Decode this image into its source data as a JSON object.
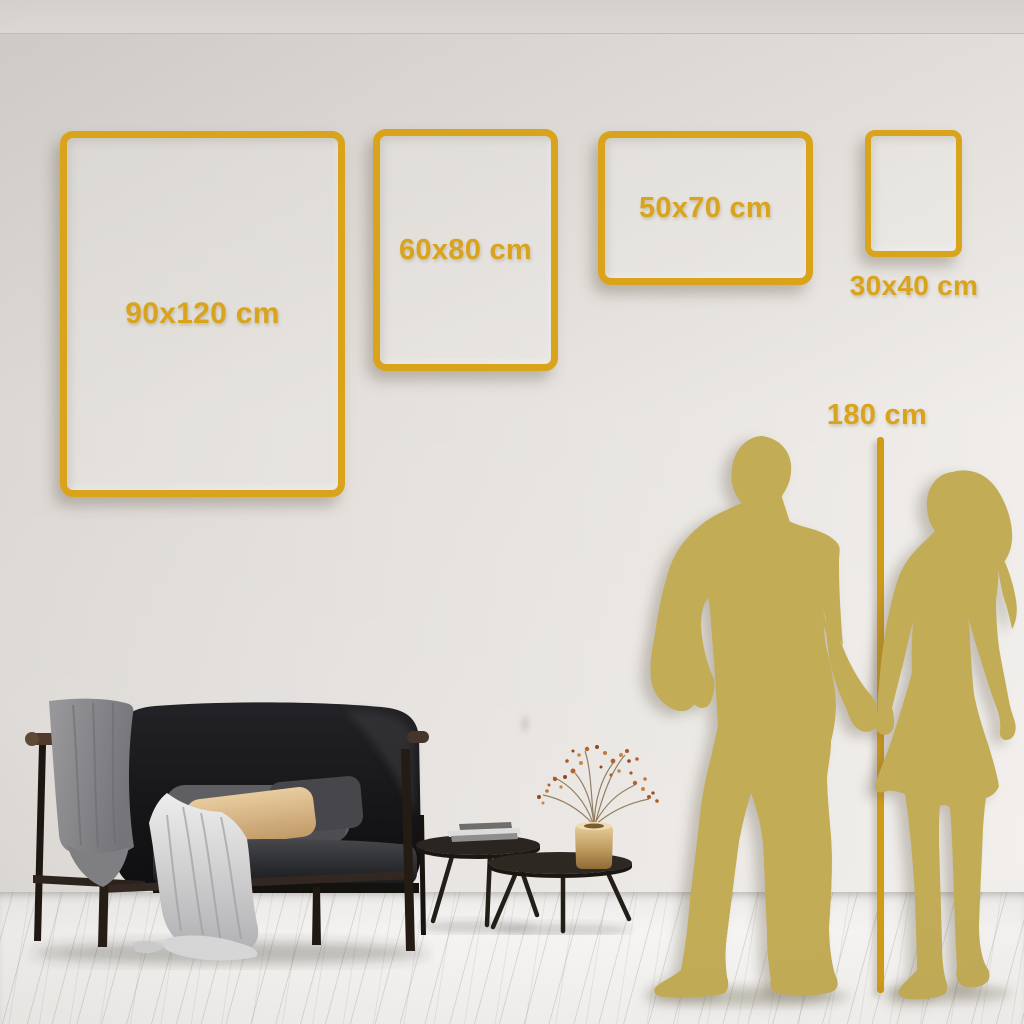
{
  "size_guide": {
    "frames": [
      {
        "label": "90x120 cm",
        "width_cm": 90,
        "height_cm": 120,
        "orientation": "portrait"
      },
      {
        "label": "60x80 cm",
        "width_cm": 60,
        "height_cm": 80,
        "orientation": "portrait"
      },
      {
        "label": "50x70 cm",
        "width_cm": 50,
        "height_cm": 70,
        "orientation": "landscape"
      },
      {
        "label": "30x40 cm",
        "width_cm": 30,
        "height_cm": 40,
        "orientation": "portrait"
      }
    ],
    "height_reference": {
      "label": "180 cm",
      "height_cm": 180
    }
  },
  "colors": {
    "accent_gold": "#D9A41C",
    "ruler_gold": "#D09C18",
    "silhouette_gold": "#C3AC56",
    "wall_light": "#EFECE9",
    "wall_dark": "#D9D5D1",
    "floor": "#F3F2F0"
  }
}
